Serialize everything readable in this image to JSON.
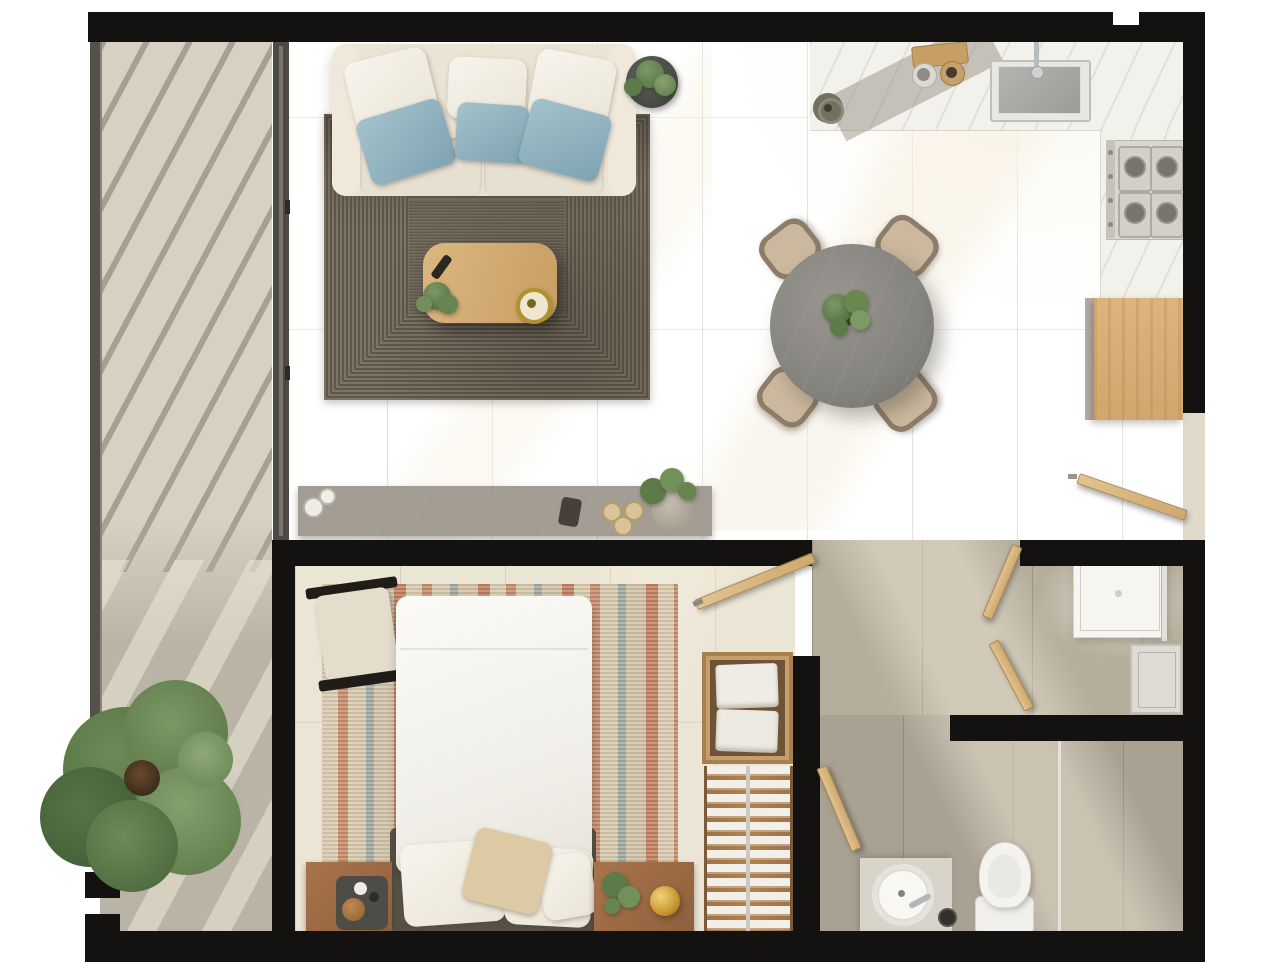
{
  "meta": {
    "title": "Top-down 3D rendered apartment floor plan",
    "type": "architectural-floor-plan-render",
    "canvas_px": {
      "width": 1283,
      "height": 962
    },
    "visible_text": "none"
  },
  "palette": {
    "wall_black": "#141210",
    "floor_cream_tile": "#e8e2d3",
    "floor_taupe_tile": "#b7af9e",
    "floor_bathroom_tile": "#a9a192",
    "balcony_marble_light": "#d8d1c2",
    "balcony_marble_dark": "#b7b1a4",
    "kitchen_counter_marble": "#f3f1ec",
    "console_marble_grey": "#a29c93",
    "wood_oak_cabinet": "#d7b076",
    "wood_door": "#d9b886",
    "wood_nightstand": "#9d6a45",
    "wood_closet": "#b08350",
    "sofa_cream": "#ebe3d4",
    "pillow_white": "#f3efe6",
    "pillow_blue": "#8fb3c0",
    "pillow_beige": "#ddc9a4",
    "rug_living_dark_woven": "#6e665a",
    "rug_bedroom_rust": "#c07c5c",
    "rug_bedroom_teal": "#9fa89f",
    "rug_bedroom_beige": "#d8c9ad",
    "dining_table_grey_marble": "#8b8984",
    "chair_beige": "#c9b59b",
    "bed_duvet_white": "#f7f5f0",
    "headboard_grey": "#575147",
    "plant_green": "#6f8c59",
    "gold_accent": "#c9982f",
    "fixture_white": "#f4f3ef",
    "glass_grey": "#cfccc5"
  },
  "structure": {
    "walls": {
      "style": "solid black poche",
      "thickness_px": 26
    },
    "openings": {
      "entry_door_right_side": true,
      "open_interior_doors": 5
    },
    "lighting": {
      "sun_shafts": "diagonal warm light bands",
      "pergola_shadow_stripes_angle_deg": 28
    }
  },
  "rooms": [
    {
      "id": "balcony",
      "label": "Balcony terrace",
      "items": [
        "large tree",
        "pergola shadow stripes",
        "marble slab floor",
        "glass railing frame",
        "sliding glass door to living room"
      ]
    },
    {
      "id": "living-room",
      "label": "Living room",
      "items": [
        "three-seat cream sofa",
        "3 white back pillows",
        "3 blue accent pillows",
        "dark woven concentric rug",
        "oak coffee table",
        "remote control",
        "potted plant on table",
        "gold round tray",
        "round dark side table with plant",
        "grey marble console with 2 cups, dark decor piece, 3 pastries, potted plant"
      ]
    },
    {
      "id": "kitchen",
      "label": "Kitchen",
      "items": [
        "white marble L-counter",
        "undermount grey sink with chrome faucet",
        "wood cutting board",
        "2 bowls",
        "round trivet pot",
        "4-burner gas cooktop",
        "oak base cabinet"
      ]
    },
    {
      "id": "dining-area",
      "label": "Dining area",
      "items": [
        "round grey marble table",
        "4 beige dining chairs",
        "green centerpiece plant"
      ]
    },
    {
      "id": "bedroom",
      "label": "Bedroom",
      "items": [
        "double bed with white duvet",
        "grey upholstered headboard",
        "2 white pillows",
        "beige accent pillow",
        "small white pillow",
        "striped woven rug (rust/teal/beige)",
        "black-frame bench with beige cushion",
        "left wood nightstand with tray, cup, bowl",
        "right wood nightstand with plant and gold sphere lamp",
        "wood shelf niche with 2 folded towels",
        "open wardrobe with hanging white clothes on central rail",
        "open wood door"
      ]
    },
    {
      "id": "hallway",
      "label": "Hallway",
      "items": [
        "taupe tile floor",
        "open wood doors",
        "sunlight shaft"
      ]
    },
    {
      "id": "shower-room",
      "label": "Shower room",
      "items": [
        "white shower tray",
        "glass panel",
        "leaning white door panel"
      ]
    },
    {
      "id": "bathroom",
      "label": "Bathroom",
      "items": [
        "stone vanity",
        "round white vessel sink with chrome faucet",
        "dark accessory jar",
        "white toilet",
        "glass partition line",
        "walk-in shower zone"
      ]
    },
    {
      "id": "entrance",
      "label": "Entrance",
      "items": [
        "open entry door on right wall",
        "threshold"
      ]
    }
  ],
  "counts": {
    "dining_chairs": 4,
    "stove_burners": 4,
    "sofa_back_pillows_white": 3,
    "sofa_pillows_blue": 3,
    "bed_pillows": 4,
    "towels": 2,
    "open_doors": 6,
    "trees": 1
  }
}
